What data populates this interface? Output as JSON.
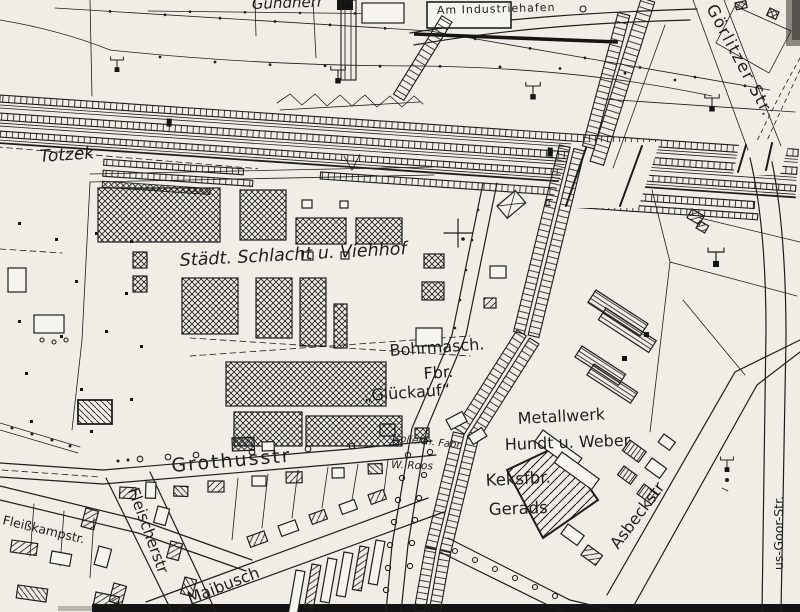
{
  "theme": {
    "paper": "#f0ede6",
    "paper2": "#f6f4ee",
    "ink": "#1e1e1e"
  },
  "map": {
    "type": "historical-city-map",
    "labels": {
      "totzek": "Totzek",
      "gundherr": "Gundherr",
      "am_industriehafen": "Am Industriehafen",
      "goerlitzer_str": "Görlitzer Str.",
      "schlachthof": "Städt. Schlacht u. Viehhof",
      "bohrmasch_line1": "Bohrmasch.",
      "bohrmasch_line2": "Fbr.",
      "bohrmasch_line3": "„Glückauf“",
      "isolier": "Jsolierm. Fabr.",
      "roos": "W. Roos",
      "metallwerk_line1": "Metallwerk",
      "metallwerk_line2": "Hundt u. Weber",
      "keksfabrik_line1": "Keksfbr.",
      "keksfabrik_line2": "Gerads",
      "grothusstr": "Grothusstr",
      "fleischerstr": "Fleischerstr",
      "fleisskampstr": "Fleißkampstr.",
      "maibusch": "Maibusch",
      "asbeckstr": "Asbeckstr",
      "goorstr": "us-Goor-Str."
    },
    "symbols": {
      "tree": "open-circle",
      "power_pole": "t-bar-pole",
      "railway": "tie-hatched-band",
      "building_hatch": "cross-hatch"
    }
  }
}
